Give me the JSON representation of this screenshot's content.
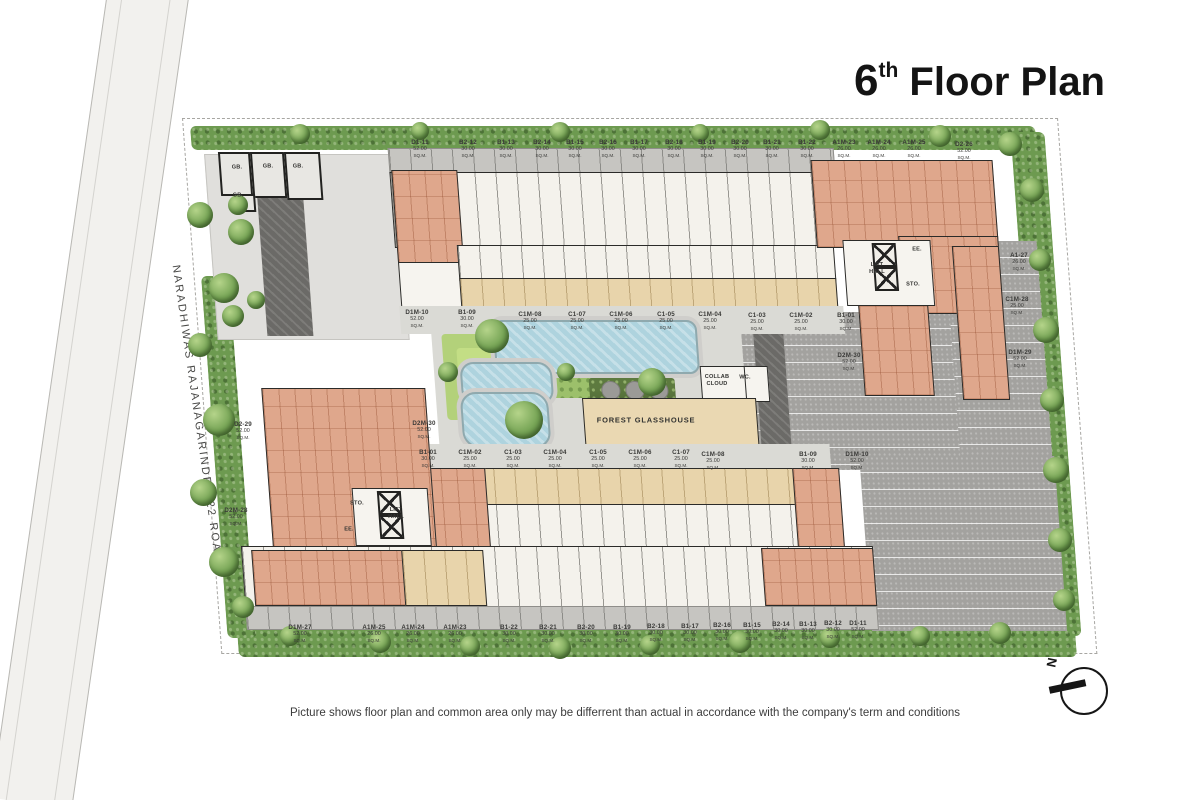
{
  "title": {
    "num": "6",
    "sup": "th",
    "rest": " Floor Plan"
  },
  "road_label": "NARADHIWAS RAJANAGARINDRA 22 ROAD",
  "disclaimer": "Picture shows floor plan and common area only may be differrent than actual in accordance with the company's term and conditions",
  "compass_n": "N",
  "sqm": "SQ.M.",
  "amenities": {
    "forest_glasshouse": "FOREST GLASSHOUSE",
    "collab_cloud": "COLLAB\nCLOUD",
    "wc": "WC.",
    "lift_hall": "LIFT\nHALL",
    "sto": "STO.",
    "ee": "EE.",
    "gb": "GB."
  },
  "unit_labels": [
    {
      "id": "D1-11",
      "area": "52.00",
      "x": 420,
      "y": 139
    },
    {
      "id": "B2-12",
      "area": "30.00",
      "x": 468,
      "y": 139
    },
    {
      "id": "B1-13",
      "area": "30.00",
      "x": 506,
      "y": 139
    },
    {
      "id": "B2-14",
      "area": "30.00",
      "x": 542,
      "y": 139
    },
    {
      "id": "B1-15",
      "area": "30.00",
      "x": 575,
      "y": 139
    },
    {
      "id": "B2-16",
      "area": "30.00",
      "x": 608,
      "y": 139
    },
    {
      "id": "B1-17",
      "area": "30.00",
      "x": 639,
      "y": 139
    },
    {
      "id": "B2-18",
      "area": "30.00",
      "x": 674,
      "y": 139
    },
    {
      "id": "B1-19",
      "area": "30.00",
      "x": 707,
      "y": 139
    },
    {
      "id": "B2-20",
      "area": "30.00",
      "x": 740,
      "y": 139
    },
    {
      "id": "B1-21",
      "area": "30.00",
      "x": 772,
      "y": 139
    },
    {
      "id": "B1-22",
      "area": "30.00",
      "x": 807,
      "y": 139
    },
    {
      "id": "A1M-23",
      "area": "26.00",
      "x": 844,
      "y": 139
    },
    {
      "id": "A1M-24",
      "area": "26.00",
      "x": 879,
      "y": 139
    },
    {
      "id": "A1M-25",
      "area": "26.00",
      "x": 914,
      "y": 139
    },
    {
      "id": "D2-26",
      "area": "52.00",
      "x": 964,
      "y": 141
    },
    {
      "id": "D1M-10",
      "area": "52.00",
      "x": 417,
      "y": 309
    },
    {
      "id": "B1-09",
      "area": "30.00",
      "x": 467,
      "y": 309
    },
    {
      "id": "C1M-08",
      "area": "25.00",
      "x": 530,
      "y": 311
    },
    {
      "id": "C1-07",
      "area": "25.00",
      "x": 577,
      "y": 311
    },
    {
      "id": "C1M-06",
      "area": "25.00",
      "x": 621,
      "y": 311
    },
    {
      "id": "C1-05",
      "area": "25.00",
      "x": 666,
      "y": 311
    },
    {
      "id": "C1M-04",
      "area": "25.00",
      "x": 710,
      "y": 311
    },
    {
      "id": "C1-03",
      "area": "25.00",
      "x": 757,
      "y": 312
    },
    {
      "id": "C1M-02",
      "area": "25.00",
      "x": 801,
      "y": 312
    },
    {
      "id": "B1-01",
      "area": "30.00",
      "x": 846,
      "y": 312
    },
    {
      "id": "D2M-30",
      "area": "52.00",
      "x": 849,
      "y": 352
    },
    {
      "id": "D2M-30",
      "area": "52.00",
      "x": 424,
      "y": 420
    },
    {
      "id": "B1-01",
      "area": "30.00",
      "x": 428,
      "y": 449
    },
    {
      "id": "C1M-02",
      "area": "25.00",
      "x": 470,
      "y": 449
    },
    {
      "id": "C1-03",
      "area": "25.00",
      "x": 513,
      "y": 449
    },
    {
      "id": "C1M-04",
      "area": "25.00",
      "x": 555,
      "y": 449
    },
    {
      "id": "C1-05",
      "area": "25.00",
      "x": 598,
      "y": 449
    },
    {
      "id": "C1M-06",
      "area": "25.00",
      "x": 640,
      "y": 449
    },
    {
      "id": "C1-07",
      "area": "25.00",
      "x": 681,
      "y": 449
    },
    {
      "id": "C1M-08",
      "area": "25.00",
      "x": 713,
      "y": 451
    },
    {
      "id": "B1-09",
      "area": "30.00",
      "x": 808,
      "y": 451
    },
    {
      "id": "D1M-10",
      "area": "52.00",
      "x": 857,
      "y": 451
    },
    {
      "id": "D1M-27",
      "area": "52.00",
      "x": 300,
      "y": 624
    },
    {
      "id": "A1M-25",
      "area": "26.00",
      "x": 374,
      "y": 624
    },
    {
      "id": "A1M-24",
      "area": "26.00",
      "x": 413,
      "y": 624
    },
    {
      "id": "A1M-23",
      "area": "26.00",
      "x": 455,
      "y": 624
    },
    {
      "id": "B1-22",
      "area": "30.00",
      "x": 509,
      "y": 624
    },
    {
      "id": "B2-21",
      "area": "30.00",
      "x": 548,
      "y": 624
    },
    {
      "id": "B2-20",
      "area": "30.00",
      "x": 586,
      "y": 624
    },
    {
      "id": "B1-19",
      "area": "30.00",
      "x": 622,
      "y": 624
    },
    {
      "id": "B2-18",
      "area": "30.00",
      "x": 656,
      "y": 623
    },
    {
      "id": "B1-17",
      "area": "30.00",
      "x": 690,
      "y": 623
    },
    {
      "id": "B2-16",
      "area": "30.00",
      "x": 722,
      "y": 622
    },
    {
      "id": "B1-15",
      "area": "30.00",
      "x": 752,
      "y": 622
    },
    {
      "id": "B2-14",
      "area": "30.00",
      "x": 781,
      "y": 621
    },
    {
      "id": "B1-13",
      "area": "30.00",
      "x": 808,
      "y": 621
    },
    {
      "id": "B2-12",
      "area": "30.00",
      "x": 833,
      "y": 620
    },
    {
      "id": "D1-11",
      "area": "52.00",
      "x": 858,
      "y": 620
    },
    {
      "id": "A1-27",
      "area": "26.00",
      "x": 1019,
      "y": 252
    },
    {
      "id": "C1M-28",
      "area": "25.00",
      "x": 1017,
      "y": 296
    },
    {
      "id": "D1M-29",
      "area": "52.00",
      "x": 1020,
      "y": 349
    },
    {
      "id": "D2-29",
      "area": "52.00",
      "x": 243,
      "y": 421
    },
    {
      "id": "D2M-28",
      "area": "52.00",
      "x": 236,
      "y": 507
    }
  ]
}
